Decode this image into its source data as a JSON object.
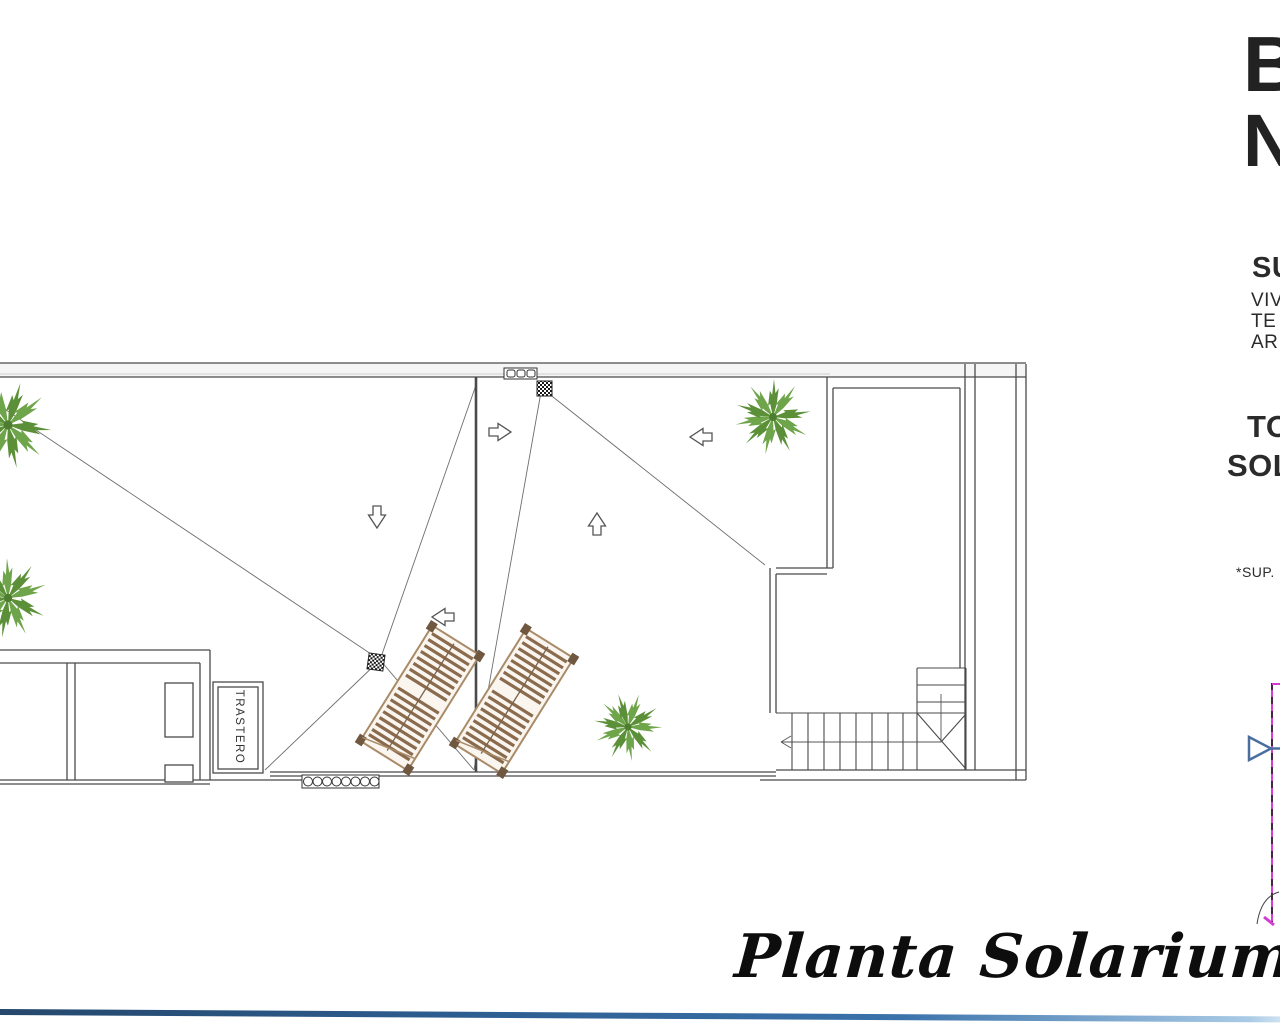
{
  "document": {
    "type": "architectural-floor-plan",
    "title": "Planta Solarium"
  },
  "plan": {
    "storage_room_label": "TRASTERO",
    "palm_count": 4,
    "sun_lounger_count": 2,
    "roof_drain_count": 2
  },
  "right_margin_text": {
    "big_letters": [
      {
        "text": "B"
      },
      {
        "text": "N"
      }
    ],
    "lines": [
      {
        "text": "SU"
      },
      {
        "text": "VIV"
      },
      {
        "text": "TE"
      },
      {
        "text": "AR"
      },
      {
        "text": "TO"
      },
      {
        "text": "SOL"
      },
      {
        "text": "*SUP."
      }
    ]
  },
  "colors": {
    "wall_line": "#4a4a4a",
    "slope_line": "#6e6e6e",
    "palm_green": "#5c9038",
    "palm_green_light": "#6fa54a",
    "lounger_wood": "#8a6b4d",
    "lounger_frame": "#a98b68",
    "footer_bar_dark": "#1c3a5e",
    "footer_bar_light": "#aacbe6",
    "adjacent_plan_magenta": "#d23ed2",
    "section_marker_blue": "#4a6f9f"
  }
}
